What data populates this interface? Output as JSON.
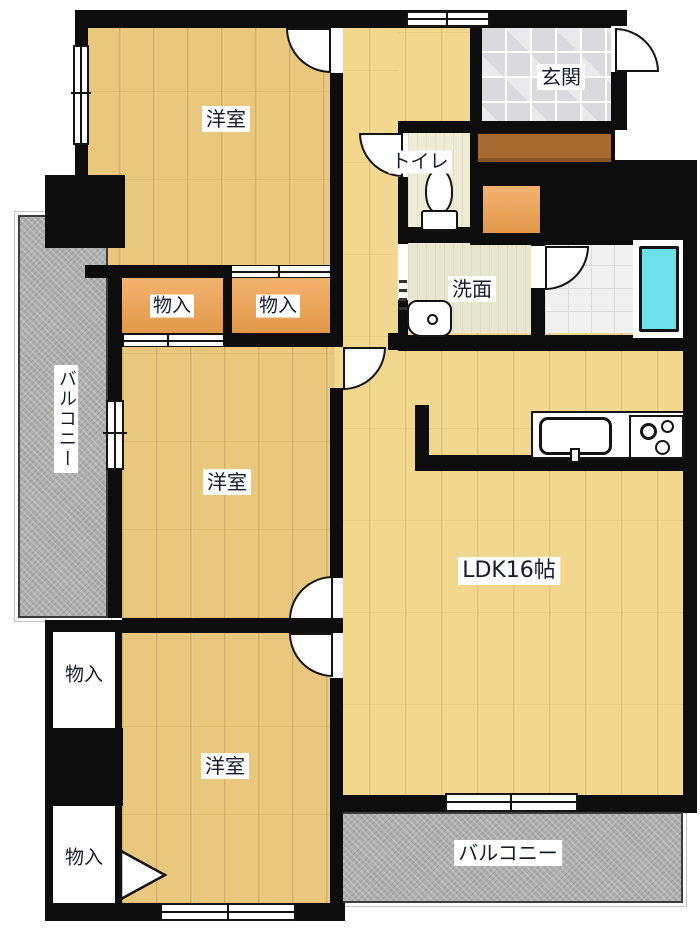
{
  "rooms": {
    "bedroom_top": {
      "label": "洋室"
    },
    "bedroom_middle": {
      "label": "洋室"
    },
    "bedroom_bottom": {
      "label": "洋室"
    },
    "ldk": {
      "label": "LDK16帖"
    },
    "entrance": {
      "label": "玄関"
    },
    "toilet": {
      "label": "トイレ"
    },
    "washroom": {
      "label": "洗面"
    },
    "storage_top_left": {
      "label": "物入"
    },
    "storage_top_right": {
      "label": "物入"
    },
    "storage_bottom_upper": {
      "label": "物入"
    },
    "storage_bottom_lower": {
      "label": "物入"
    },
    "balcony_left": {
      "label": "バルコニー"
    },
    "balcony_bottom": {
      "label": "バルコニー"
    }
  },
  "colors": {
    "wall": "#0d0d0d",
    "bedroom_floor": "#e9c77d",
    "ldk_floor": "#f1d88e",
    "storage": "#f0a24f",
    "balcony": "#aeaeae",
    "entrance_tile": "#d9d9de",
    "hall_step": "#a5682f",
    "toilet_floor": "#efecd5",
    "washroom_floor": "#e9e6cf",
    "bath_tile": "#f0f0f0",
    "bathtub": "#6ee0e9",
    "fixture": "#ffffff",
    "label_text": "#171b2e",
    "label_bg": "#ffffff"
  }
}
